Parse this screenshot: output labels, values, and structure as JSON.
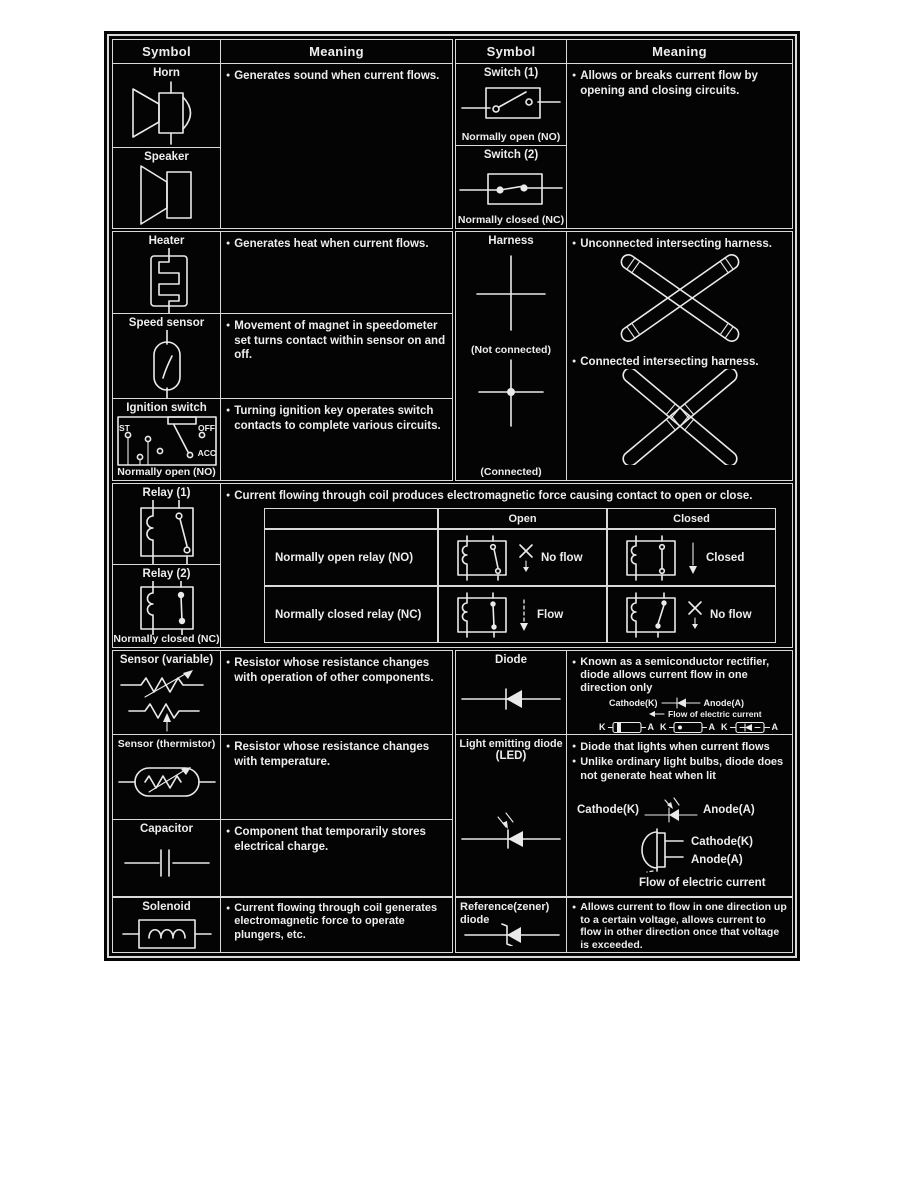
{
  "ui": {
    "bullet": "●"
  },
  "header": {
    "symbol": "Symbol",
    "meaning": "Meaning"
  },
  "horn": {
    "title": "Horn",
    "meaning": "Generates sound when current flows."
  },
  "speaker": {
    "title": "Speaker"
  },
  "switch1": {
    "title": "Switch (1)",
    "caption": "Normally open (NO)"
  },
  "switch2": {
    "title": "Switch (2)",
    "caption": "Normally closed (NC)"
  },
  "switch_meaning": "Allows or breaks current flow by opening and closing circuits.",
  "heater": {
    "title": "Heater",
    "meaning": "Generates heat when current flows."
  },
  "speed": {
    "title": "Speed sensor",
    "meaning": "Movement of magnet in speedometer set turns contact within sensor on and off."
  },
  "ignition": {
    "title": "Ignition switch",
    "caption": "Normally open (NO)",
    "meaning": "Turning ignition key operates switch contacts to complete various circuits.",
    "st": "ST",
    "off": "OFF",
    "acc": "ACC"
  },
  "harness": {
    "title": "Harness",
    "cap_nc": "(Not connected)",
    "cap_c": "(Connected)",
    "mean_nc": "Unconnected intersecting harness.",
    "mean_c": "Connected intersecting harness."
  },
  "relay1": {
    "title": "Relay (1)"
  },
  "relay2": {
    "title": "Relay (2)",
    "caption": "Normally closed (NC)"
  },
  "relay": {
    "meaning": "Current flowing through coil produces electromagnetic force causing contact to open or close.",
    "col_open": "Open",
    "col_closed": "Closed",
    "r1_label": "Normally open relay (NO)",
    "r1_open": "No flow",
    "r1_closed": "Closed",
    "r2_label": "Normally closed relay (NC)",
    "r2_open": "Flow",
    "r2_closed": "No flow"
  },
  "sensor_var": {
    "title": "Sensor (variable)",
    "meaning": "Resistor whose resistance changes with operation of other components."
  },
  "thermistor": {
    "title": "Sensor (thermistor)",
    "meaning": "Resistor whose resistance changes with temperature."
  },
  "capacitor": {
    "title": "Capacitor",
    "meaning": "Component that temporarily stores electrical charge."
  },
  "solenoid": {
    "title": "Solenoid",
    "meaning": "Current flowing through coil generates electromagnetic force to operate plungers, etc."
  },
  "diode": {
    "title": "Diode",
    "meaning": "Known as a semiconductor rectifier, diode allows current flow in one direction only",
    "cathode": "Cathode(K)",
    "anode": "Anode(A)",
    "flow": "Flow of electric current",
    "k": "K",
    "a": "A"
  },
  "led": {
    "title1": "Light emitting diode",
    "title2": "(LED)",
    "m1": "Diode that lights when current flows",
    "m2": "Unlike ordinary light bulbs, diode does not generate heat when lit",
    "cathode": "Cathode(K)",
    "anode": "Anode(A)",
    "cathode2": "Cathode(K)",
    "anode2": "Anode(A)",
    "flow": "Flow of electric current"
  },
  "zener": {
    "title1": "Reference(zener)",
    "title2": "diode",
    "meaning": "Allows current to flow in one direction up to a certain voltage, allows current to flow in other direction once that voltage is exceeded."
  }
}
